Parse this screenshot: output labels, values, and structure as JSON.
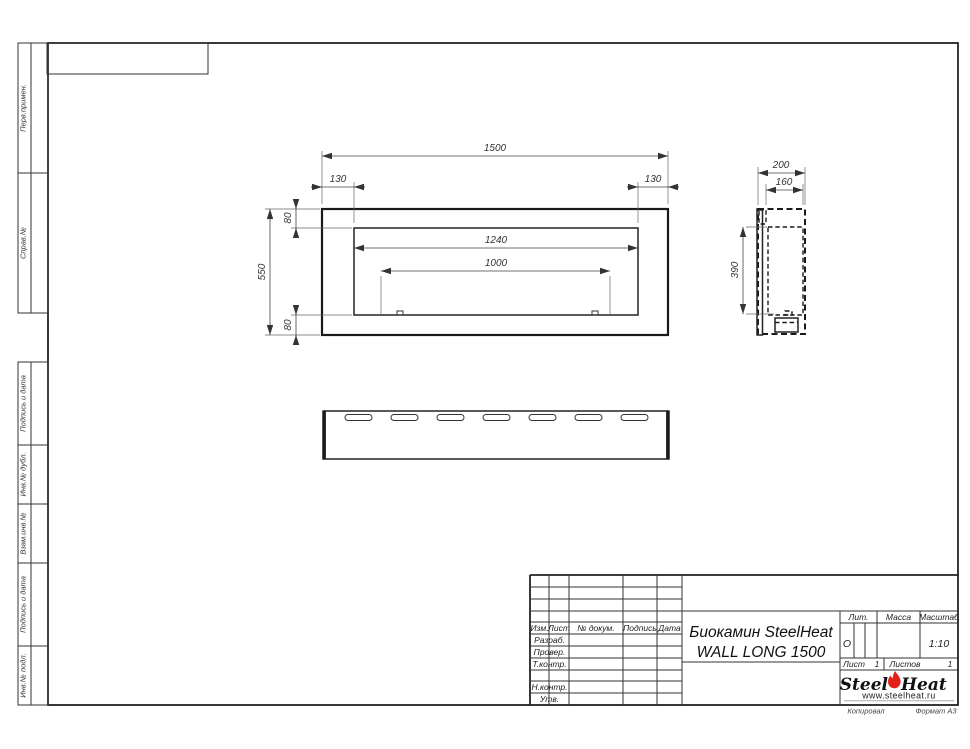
{
  "margins": {
    "perv": "Перв.примен.",
    "sprav": "Справ.№",
    "podp1": "Подпись и дата",
    "invdub": "Инв.№ дубл.",
    "vzam": "Взам.инв.№",
    "podp2": "Подпись и дата",
    "invpodl": "Инв.№ подл."
  },
  "dims": {
    "front_total_width": "1500",
    "front_left_inset": "130",
    "front_right_inset": "130",
    "front_top_inset": "80",
    "front_total_height": "550",
    "front_bottom_inset": "80",
    "front_opening_width": "1240",
    "front_burner_width": "1000",
    "side_depth": "200",
    "side_inner_depth": "160",
    "side_inner_height": "390"
  },
  "title_block": {
    "product_line1": "Биокамин SteelHeat",
    "product_line2": "WALL LONG 1500",
    "columns": {
      "izm": "Изм.",
      "list": "Лист",
      "doc": "№ докум.",
      "sign": "Подпись",
      "date": "Дата"
    },
    "rows": {
      "razrab": "Разраб.",
      "prover": "Провер.",
      "tkontr": "Т.контр.",
      "nkontr": "Н.контр.",
      "utv": "Утв."
    },
    "lit_label": "Лит.",
    "lit_value": "О",
    "mass_label": "Масса",
    "scale_label": "Масштаб",
    "scale_value": "1:10",
    "sheet_label": "Лист",
    "sheet_value": "1",
    "sheets_label": "Листов",
    "sheets_value": "1",
    "copied_label": "Копировал",
    "format_label": "Формат А3"
  },
  "logo": {
    "steel": "Steel",
    "heat": "Heat",
    "site": "www.steelheat.ru",
    "flame_color": "#e32119"
  },
  "colors": {
    "line": "#1a1a1a"
  }
}
